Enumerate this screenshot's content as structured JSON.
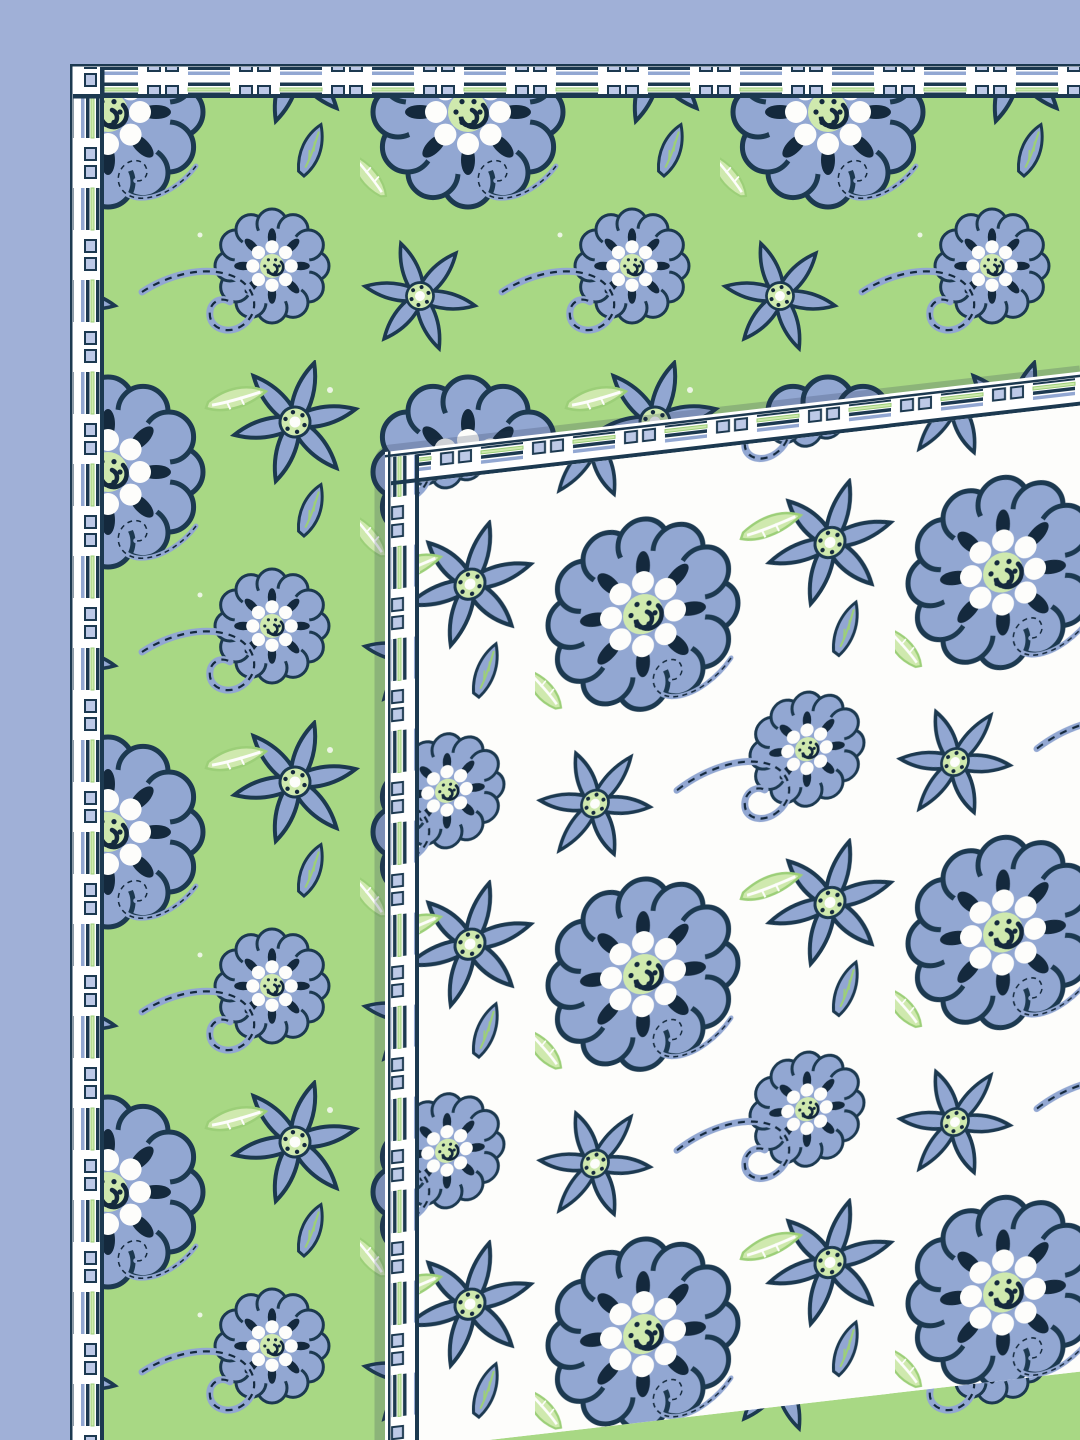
{
  "scene": {
    "subject": "Floral printed bedsheet set photographed flat on a plain periwinkle backdrop",
    "layers": [
      {
        "name": "green-sheet",
        "description": "Green cotton sheet printed with periwinkle-blue Jacobean flowers, scroll stems and leaves; white block-print border band along its top and left edges"
      },
      {
        "name": "white-sheet",
        "description": "Matching white sheet layered over the lower-right, same blue floral print on white ground, with the same white block-print border band along its top and left edges; top edge rises slightly toward the right"
      }
    ],
    "pattern_motifs": [
      "pompom-flower",
      "star-flower",
      "scroll-stem",
      "mint-leaf",
      "blue-leaf",
      "striped-block-border",
      "twin-square-border"
    ]
  },
  "colors": {
    "backdrop": "#a0b0d7",
    "green_ground": "#a8d884",
    "white_ground": "#fdfdfb",
    "petal_blue": "#92a7d2",
    "petal_light": "#bdc9e7",
    "outline_navy": "#1c3950",
    "deep_navy": "#14293d",
    "mint_green": "#cfe9ae",
    "leaf_green": "#9ccf78",
    "band_white": "#ffffff",
    "shadow": "rgba(40,55,80,0.22)"
  }
}
